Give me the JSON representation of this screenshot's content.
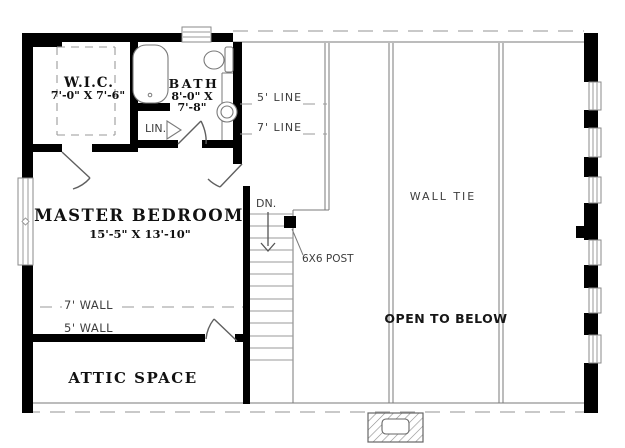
{
  "plan": {
    "title": "Second floor plan",
    "rooms": {
      "wic": {
        "name": "W.I.C.",
        "dims": "7'-0\" X 7'-6\""
      },
      "bath": {
        "name": "BATH",
        "dims1": "8'-0\" X",
        "dims2": "7'-8\""
      },
      "linen": {
        "name": "LIN."
      },
      "master": {
        "name": "MASTER BEDROOM",
        "dims": "15'-5\" X 13'-10\""
      },
      "attic": {
        "name": "ATTIC SPACE"
      }
    },
    "labels": {
      "line5": "5' LINE",
      "line7": "7' LINE",
      "wall7": "7' WALL",
      "wall5": "5' WALL",
      "down": "DN.",
      "post": "6X6 POST",
      "wall_tie": "WALL TIE",
      "open_to_below": "OPEN TO BELOW"
    },
    "colors": {
      "wall": "#000000",
      "thin_line": "#7a7a7a",
      "dash_line": "#a9a9a9",
      "background": "#ffffff"
    }
  }
}
